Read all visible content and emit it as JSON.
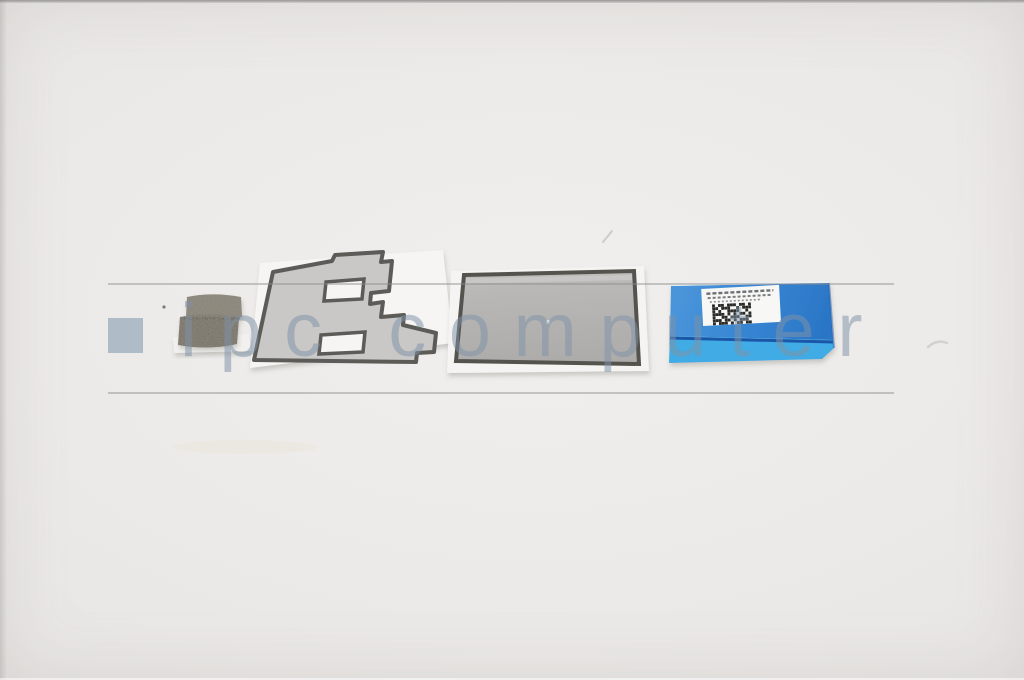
{
  "watermark": {
    "text": "ipc computer",
    "square_color": "rgba(163,180,194,0.85)",
    "text_color": "rgba(126,146,166,0.52)",
    "rule_color": "rgba(140,140,140,0.45)"
  },
  "scene": {
    "description": "Product photo of a laptop spare-part kit on a light gray surface: small dark foam cushion, gray die-cut adhesive sticker on white liner, gray rectangular adhesive film on white liner, and a blue mylar pull-tab cover with a white barcode label (micro-text illegible).",
    "background_color": "#eceae8",
    "foam": {
      "description": "dark gray textured foam cushion, two stacked bars",
      "top_color": "#8b867b",
      "bottom_color": "#7b766c",
      "liner_color": "#f2f1ef"
    },
    "sticker": {
      "description": "gray die-cut E-shaped adhesive sticker with dark outline on white liner",
      "fill": "#c9c8c6",
      "outline": "#5c5b57",
      "liner": "#f6f5f3"
    },
    "film": {
      "description": "gray rectangular adhesive film with dark border on white liner",
      "fill": "#b5b4b2",
      "outline": "#54534e",
      "liner": "#f5f4f2",
      "highlight": "#cccbc9"
    },
    "mylar": {
      "description": "blue mylar cover, darker upper panel and bright cyan lower band, white barcode label on top",
      "top_color": "#3584d2",
      "band_color": "#41abe4",
      "separator_color": "#1a57a8",
      "edge_highlight": "#e8f1fa",
      "label_color": "#f7f7f6"
    },
    "barcode": {
      "color": "#2a2a28",
      "pattern": [
        "1011011101101",
        "1101110010111",
        "1010011110010",
        "1111010101101",
        "1001101110011",
        "1110110101110",
        "1011101011011"
      ]
    }
  }
}
